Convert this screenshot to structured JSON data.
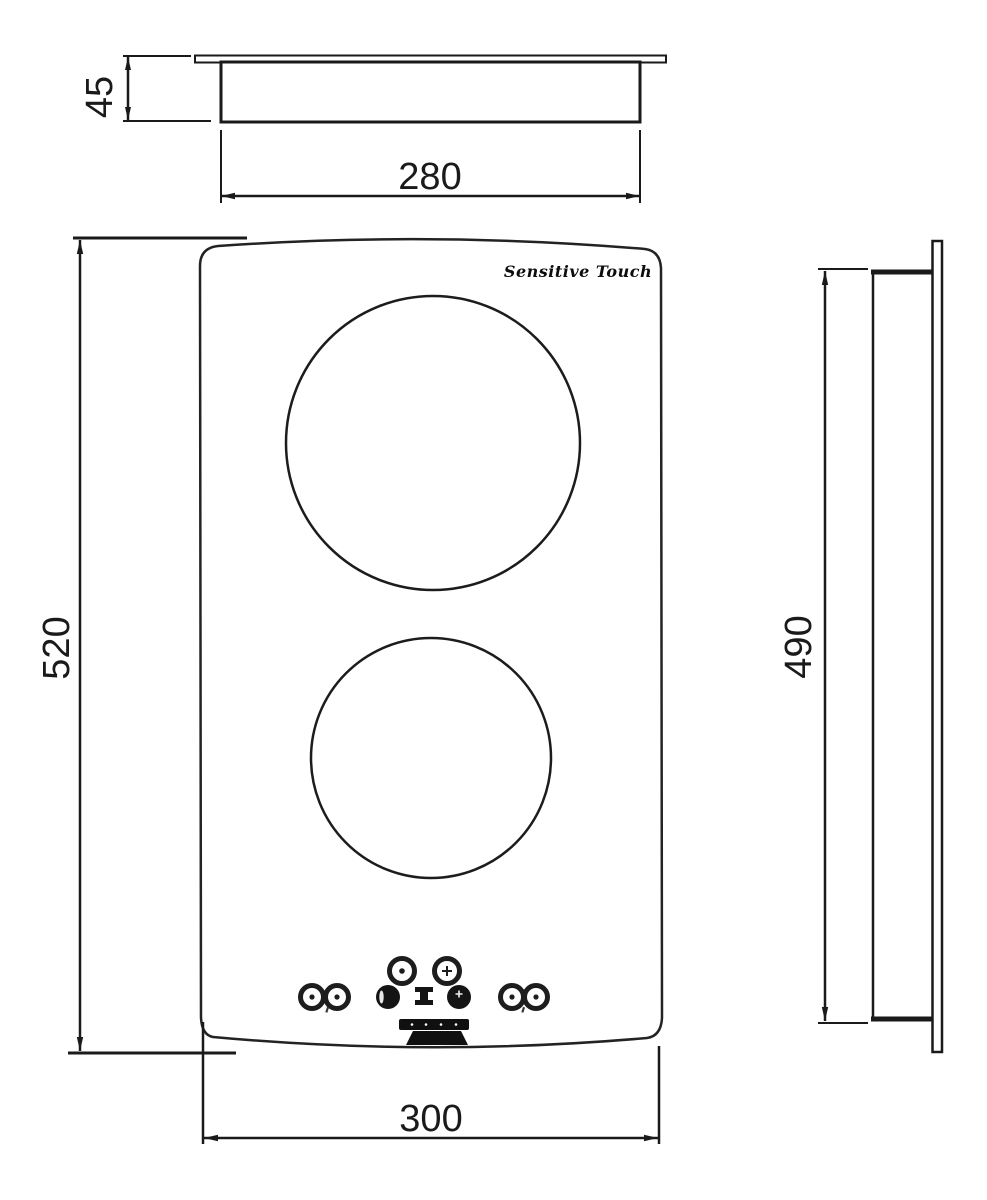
{
  "colors": {
    "line": "#1a1a1a",
    "background": "#ffffff",
    "control_dark": "#141414"
  },
  "top_view": {
    "depth_label": "45",
    "width_label": "280"
  },
  "front_view": {
    "brand_label": "Sensitive Touch",
    "height_label": "520",
    "width_label": "300"
  },
  "side_view": {
    "height_label": "490"
  }
}
